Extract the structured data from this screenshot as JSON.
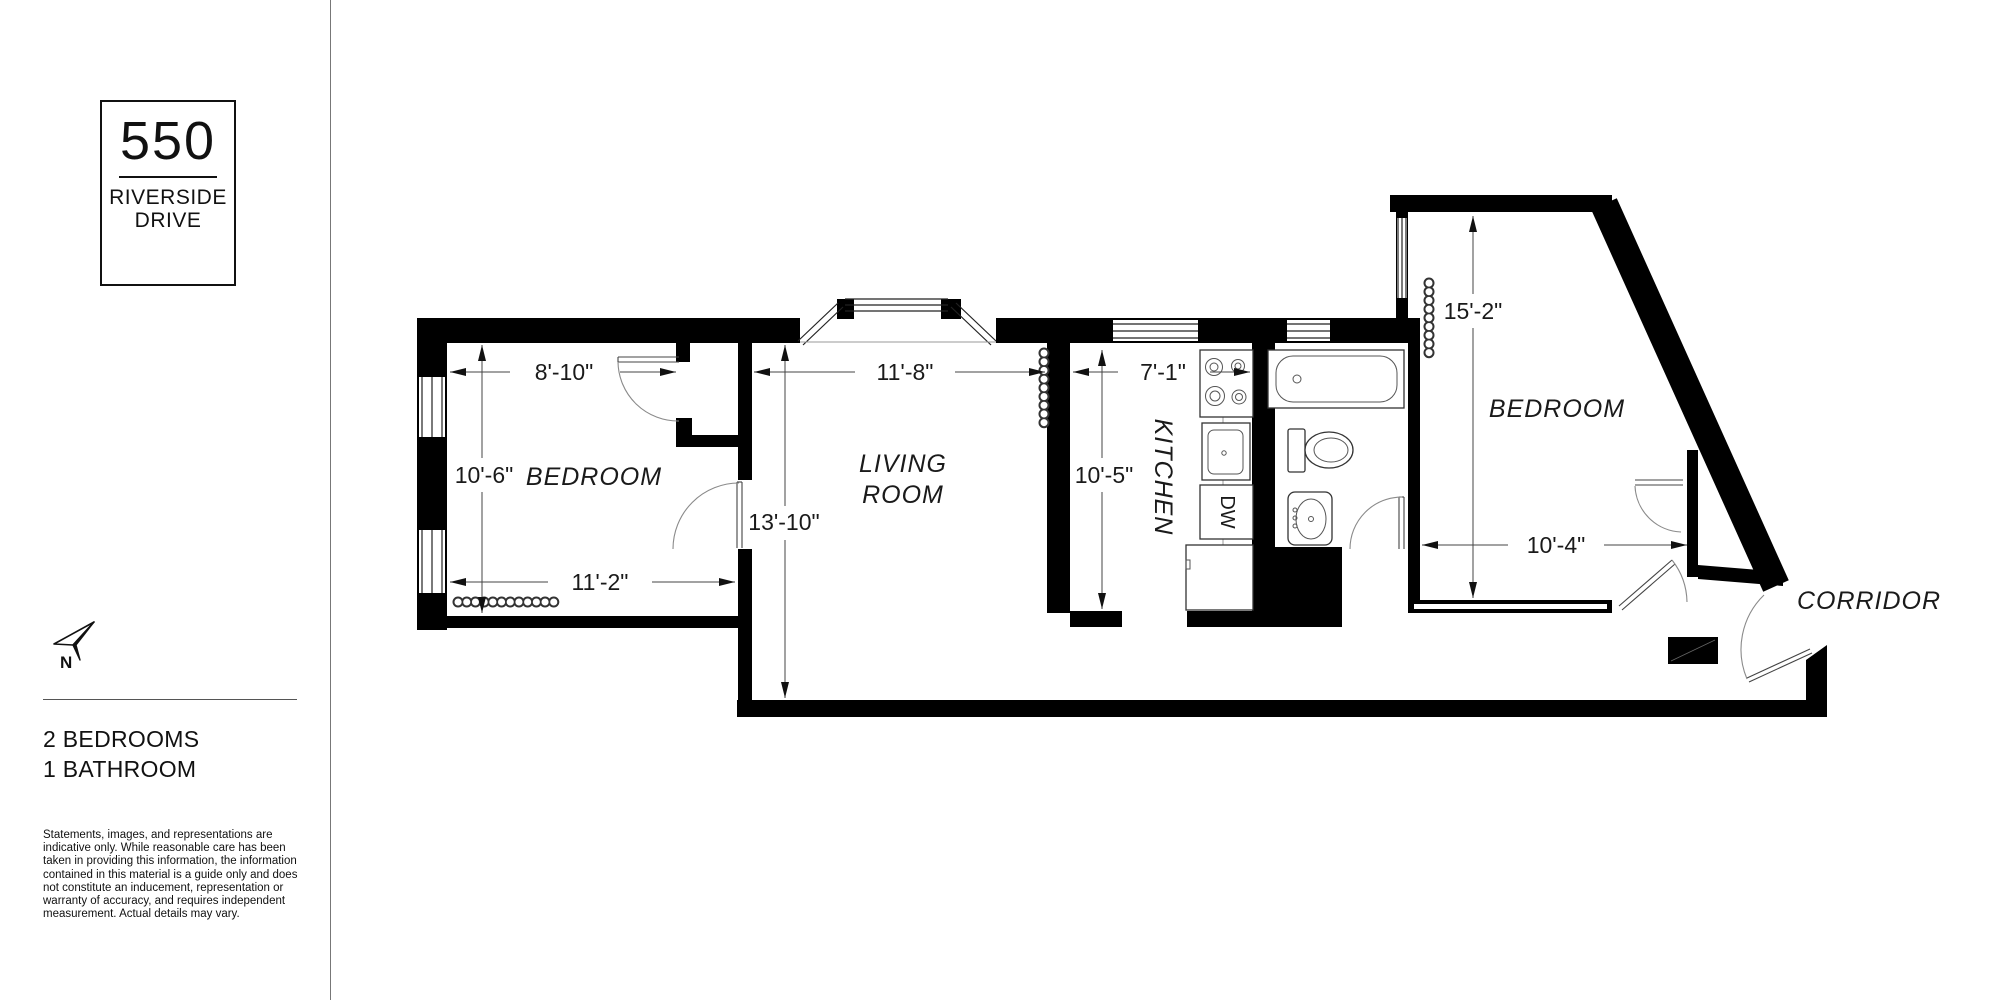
{
  "branding": {
    "building_number": "550",
    "street_line1": "RIVERSIDE",
    "street_line2": "DRIVE"
  },
  "compass": {
    "north_label": "N"
  },
  "summary": {
    "line1": "2 BEDROOMS",
    "line2": "1 BATHROOM"
  },
  "disclaimer": "Statements, images, and representations are indicative only. While reasonable care has been taken in providing this information, the information contained in this material is a guide only and does not constitute an inducement, representation or warranty of accuracy, and requires independent measurement. Actual details may vary.",
  "floorplan": {
    "rooms": {
      "bedroom1": {
        "label": "BEDROOM",
        "width_top": "8'-10\"",
        "height": "10'-6\"",
        "width_bottom": "11'-2\""
      },
      "living": {
        "label_line1": "LIVING",
        "label_line2": "ROOM",
        "width": "11'-8\"",
        "height": "13'-10\""
      },
      "kitchen": {
        "label": "KITCHEN",
        "width": "7'-1\"",
        "height": "10'-5\"",
        "dishwasher_label": "DW"
      },
      "bedroom2": {
        "label": "BEDROOM",
        "height": "15'-2\"",
        "width": "10'-4\""
      },
      "corridor": {
        "label": "CORRIDOR"
      }
    }
  },
  "colors": {
    "walls": "#000000",
    "thin_lines": "#333333",
    "text": "#111111",
    "background": "#ffffff"
  }
}
